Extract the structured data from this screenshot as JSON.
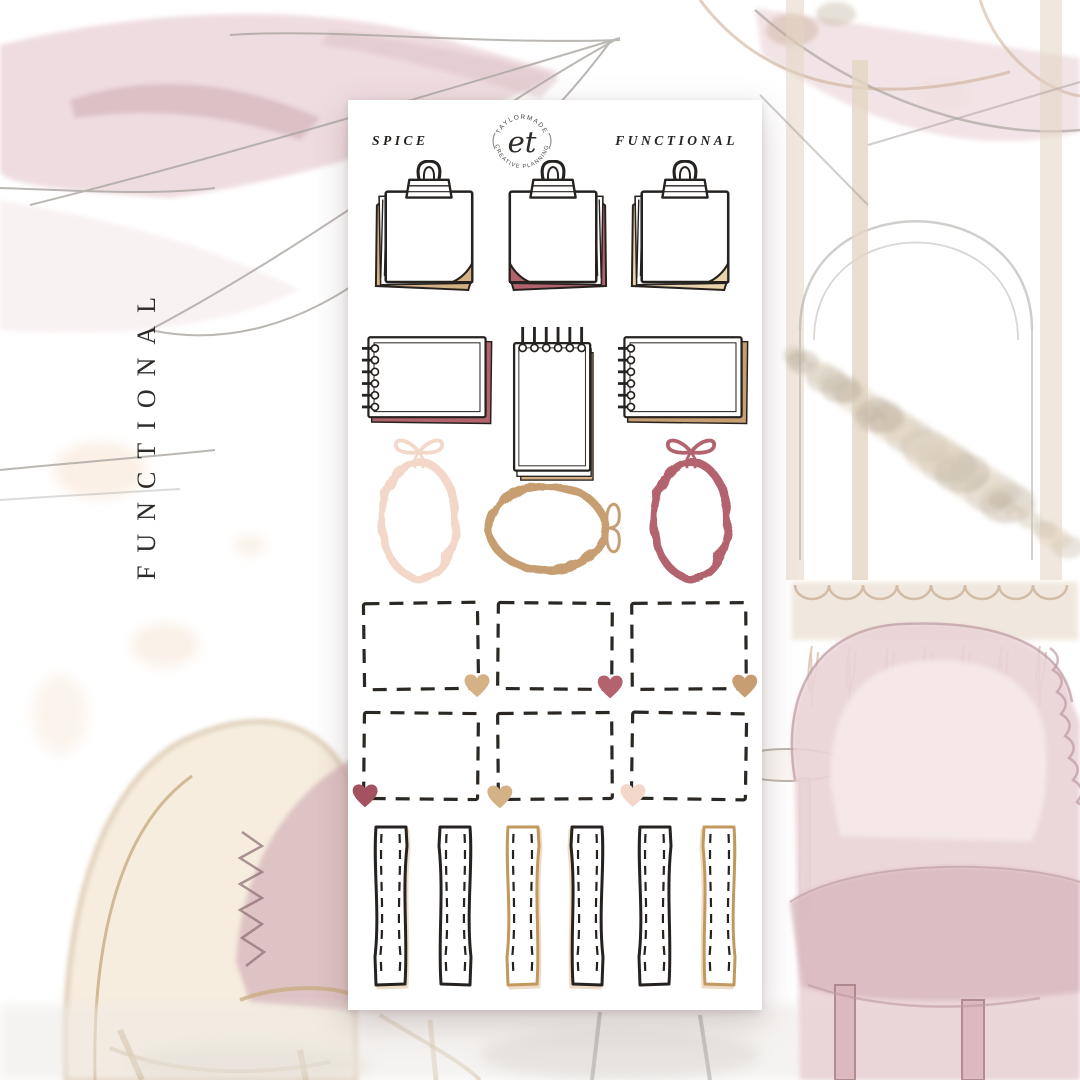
{
  "side_label": "FUNCTIONAL",
  "sheet": {
    "header": {
      "left_label": "SPICE",
      "right_label": "FUNCTIONAL",
      "logo": {
        "top_text": "TAYLORMADE",
        "bottom_text": "CREATIVE PLANNING",
        "monogram": "et"
      }
    }
  },
  "colors": {
    "ink": "#262220",
    "rose": "#b2636d",
    "rose_deep": "#a4525f",
    "camel": "#c79e72",
    "sand": "#d5b286",
    "cream": "#e9d3ab",
    "blush": "#f3d8ca",
    "gold": "#c2995c",
    "paper": "#ffffff"
  },
  "background_palette": {
    "umbrella_pink": "#eedade",
    "umbrella_shade": "#d9bdc3",
    "sketch_gray": "#aaa5a0",
    "chair_beige": "#f0e2c9",
    "chair_beige_line": "#c9ad85",
    "pillow_mauve": "#d8b8bd",
    "armchair_pink": "#e9d2d6",
    "armchair_seat": "#d8b9bf",
    "armchair_line": "#bc9aa2",
    "foliage": "#cfc5b4",
    "foliage_dark": "#bfb29d",
    "planter": "#e4d6c3",
    "wood_tan": "#c8a98e",
    "spot_peach": "#f6e3d2"
  },
  "stickers": {
    "clipboards": [
      {
        "type": "clipboard-note",
        "accent": "sand",
        "fold": "bottom-right"
      },
      {
        "type": "clipboard-note",
        "accent": "rose",
        "fold": "bottom-left"
      },
      {
        "type": "clipboard-note",
        "accent": "cream",
        "fold": "bottom-right"
      }
    ],
    "notebooks": [
      {
        "type": "spiral-notebook-landscape",
        "accent": "rose"
      },
      {
        "type": "spiral-notepad-portrait",
        "accent": "sand"
      },
      {
        "type": "spiral-notebook-landscape",
        "accent": "camel"
      }
    ],
    "frames": [
      {
        "type": "scalloped-oval-frame",
        "orientation": "vertical",
        "color": "blush",
        "bow": "top"
      },
      {
        "type": "scalloped-oval-frame",
        "orientation": "horizontal",
        "color": "camel",
        "bow": "right"
      },
      {
        "type": "scalloped-oval-frame",
        "orientation": "vertical",
        "color": "rose",
        "bow": "top"
      }
    ],
    "dashed_rows": [
      [
        {
          "heart": "sand",
          "corner": "bottom-right"
        },
        {
          "heart": "rose",
          "corner": "bottom-right"
        },
        {
          "heart": "camel",
          "corner": "bottom-right"
        }
      ],
      [
        {
          "heart": "rose_deep",
          "corner": "bottom-left"
        },
        {
          "heart": "sand",
          "corner": "bottom-left"
        },
        {
          "heart": "blush",
          "corner": "bottom-left"
        }
      ]
    ],
    "strips": [
      {
        "edge": "ink",
        "tint": true
      },
      {
        "edge": "ink",
        "tint": false
      },
      {
        "edge": "gold",
        "tint": true
      },
      {
        "edge": "ink",
        "tint": true
      },
      {
        "edge": "ink",
        "tint": false
      },
      {
        "edge": "gold",
        "tint": true
      }
    ]
  }
}
